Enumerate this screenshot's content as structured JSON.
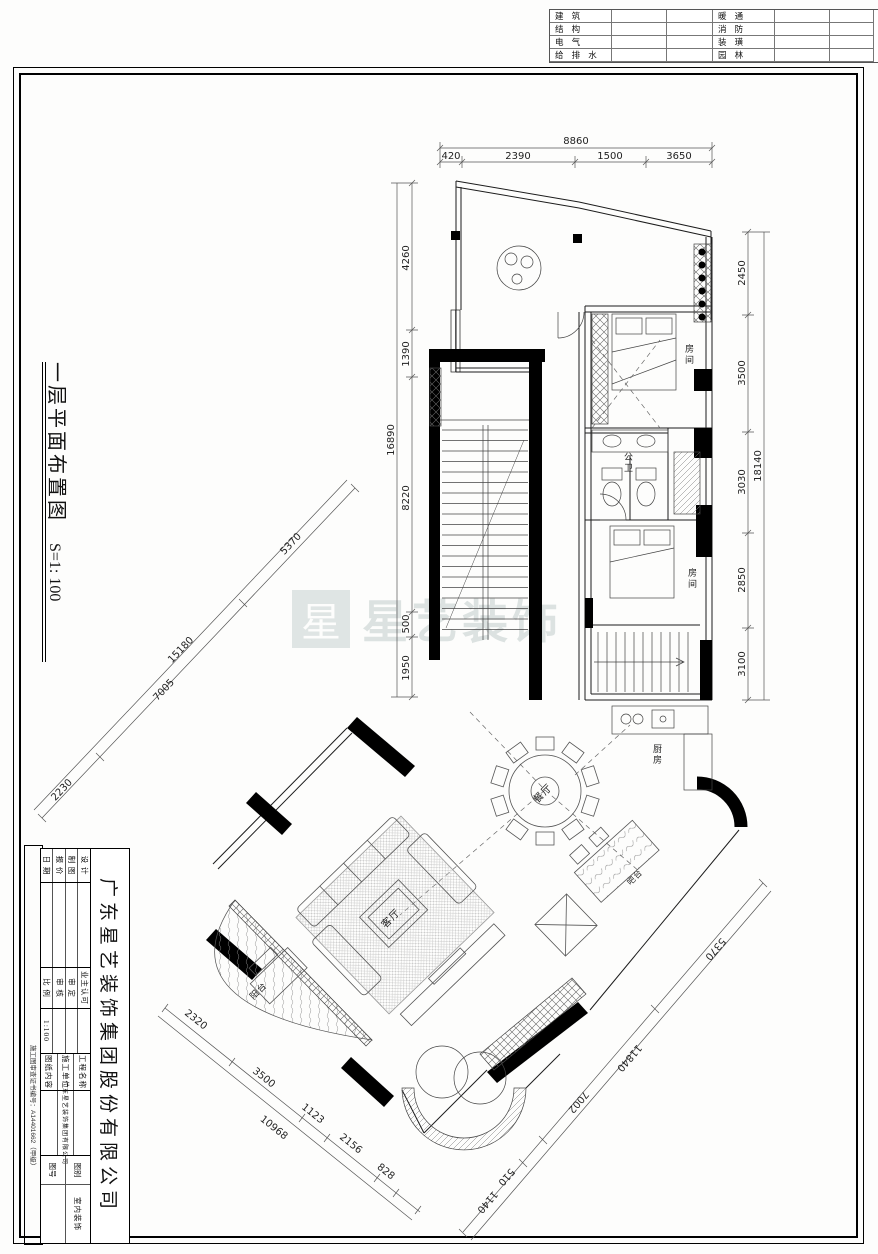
{
  "spec_table": {
    "rows_left": [
      "建 筑",
      "结 构",
      "电 气",
      "给 排 水"
    ],
    "rows_right": [
      "暖 通",
      "消 防",
      "装 璜",
      "园 林"
    ]
  },
  "side_title": {
    "title": "一层平面布置图",
    "scale": "S=1: 100"
  },
  "watermark": {
    "logo_char": "星",
    "text": "星艺装饰"
  },
  "rooms": {
    "bedroom1": "房间",
    "bath": "公卫",
    "bedroom2": "房间",
    "kitchen": "厨房",
    "dining": "餐厅",
    "living": "客厅",
    "bar": "吧台",
    "balcony": "阳台"
  },
  "dims": {
    "top": {
      "overall": "8860",
      "s1": "420",
      "s2": "2390",
      "s3": "1500",
      "s4": "3650"
    },
    "left": {
      "overall": "16890",
      "s1": "4260",
      "s2": "1390",
      "s3": "8220",
      "s4": "500",
      "s5": "1950"
    },
    "right": {
      "overall": "18140",
      "s1": "2450",
      "s2": "3500",
      "s3": "3030",
      "s4": "2850",
      "s5": "3100"
    },
    "diag_left": {
      "overall": "15180",
      "s1": "2230",
      "s2": "7005",
      "s3": "5370"
    },
    "diag_bottom": {
      "overall": "10968",
      "s1": "2320",
      "s2": "3500",
      "s3": "1123",
      "s4": "2156",
      "s5": "828"
    },
    "diag_right": {
      "overall": "11840",
      "s1": "5370",
      "s2": "7002",
      "s3": "510",
      "s4": "1140"
    }
  },
  "title_block": {
    "company": "广东星艺装饰集团股份有限公司",
    "fields_a": [
      "设 计",
      "制 图",
      "报 价",
      "日 期"
    ],
    "fields_b": [
      "业主认可",
      "审 定",
      "审 核",
      "比 例"
    ],
    "scale_value": "1:100",
    "fields_c": [
      "工程名称",
      "施工单位",
      "图纸内容"
    ],
    "builder": "广东星艺装饰集团有限公司",
    "sheet_type_label": "图别",
    "sheet_type": "室内装饰",
    "sheet_no_label": "图号",
    "cert": "施工图审查证书编号：A14401662（甲级）"
  }
}
